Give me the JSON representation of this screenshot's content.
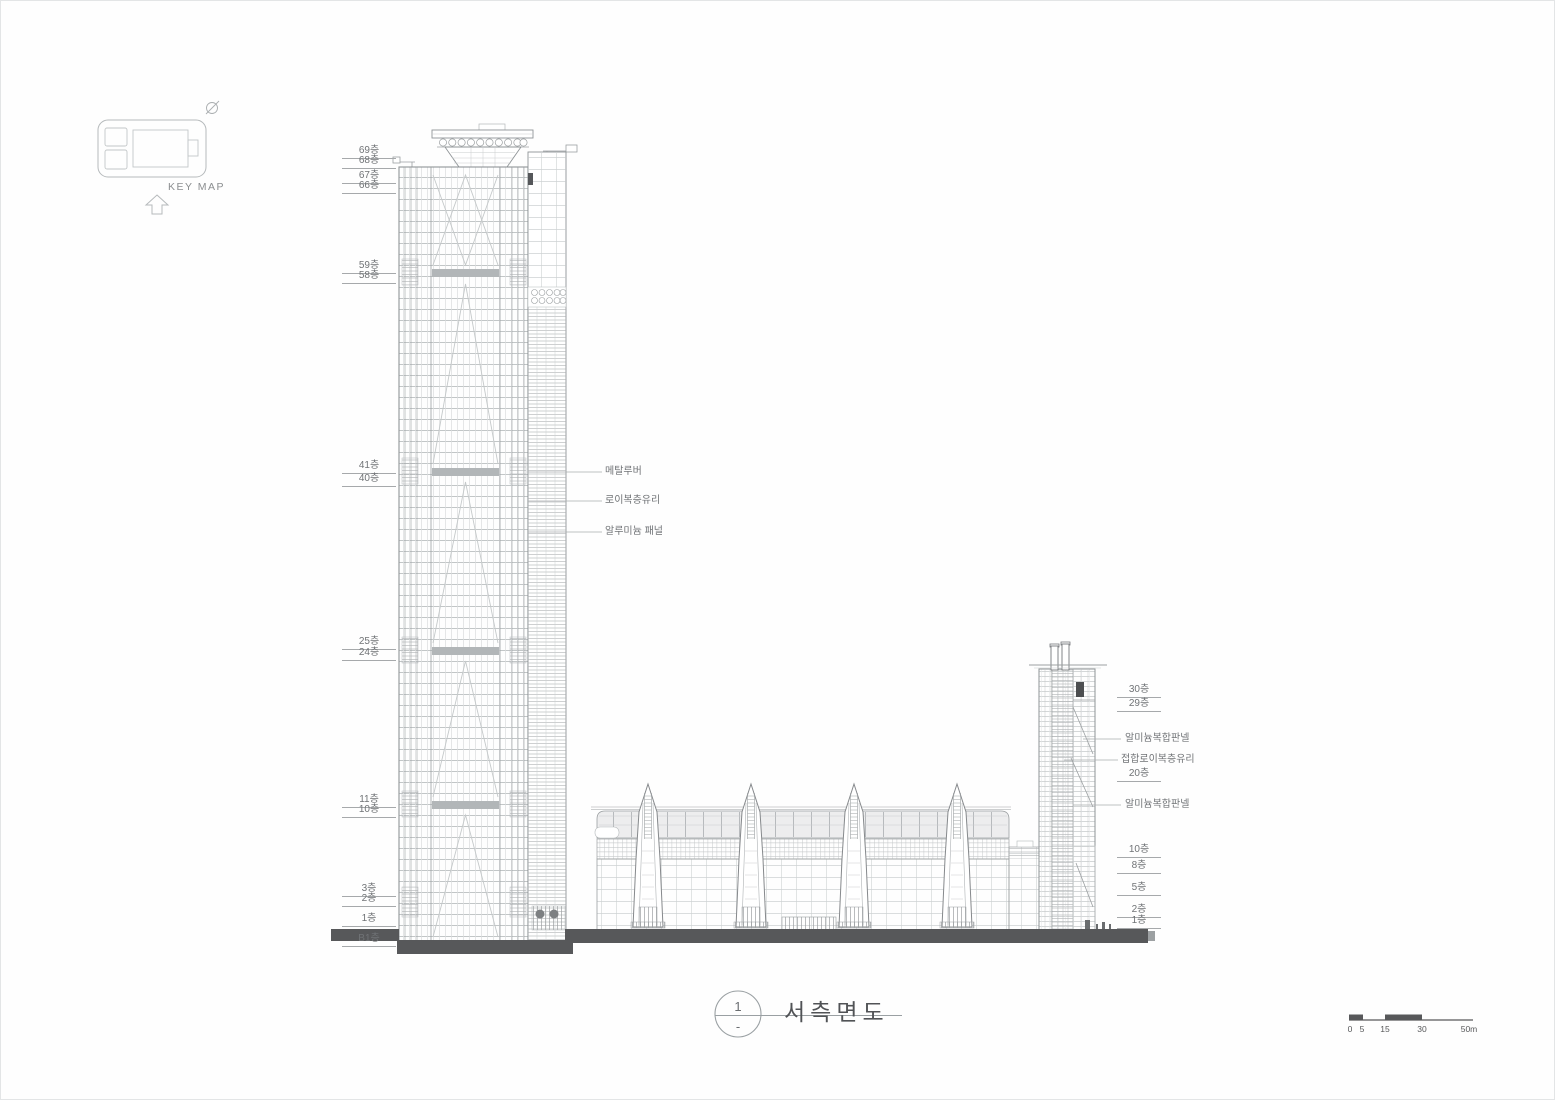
{
  "sheet": {
    "view_title": "서측면도",
    "view_number": "1",
    "view_number_sub": "-"
  },
  "key_map": {
    "label": "KEY MAP"
  },
  "left_floor_labels": [
    "69층",
    "68층",
    "67층",
    "66층",
    "59층",
    "58층",
    "41층",
    "40층",
    "25층",
    "24층",
    "11층",
    "10층",
    "3층",
    "2층",
    "1층",
    "B1층"
  ],
  "tower_annotations": [
    "메탈루버",
    "로이복층유리",
    "알루미늄 패널"
  ],
  "right_labels": {
    "floors_upper": [
      "30층",
      "29층"
    ],
    "panel_top": "알미늄복합판넬",
    "laminated_glass": "접합로이복층유리",
    "floor_20": "20층",
    "panel_mid": "알미늄복합판넬",
    "floors_lower": [
      "10층",
      "8층",
      "5층",
      "2층",
      "1층"
    ]
  },
  "scale_bar": {
    "labels": [
      "0",
      "5",
      "15",
      "30",
      "50m"
    ]
  },
  "colors": {
    "line": "#8f9497",
    "line_light": "#c9cdce",
    "band": "#b2b6b8",
    "ground": "#57585a",
    "text": "#707376"
  }
}
